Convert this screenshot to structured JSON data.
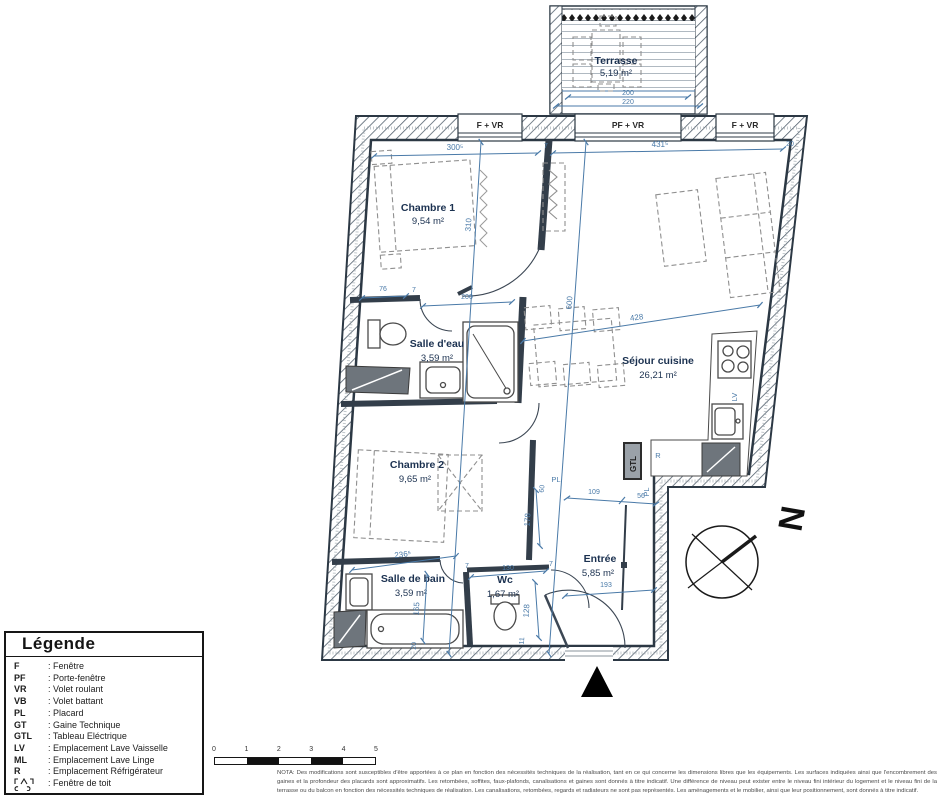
{
  "colors": {
    "wall": "#35424f",
    "dimension_blue": "#4a7aa8",
    "room_label_navy": "#1b3150",
    "furniture_gray": "#8f8f8f"
  },
  "terrace": {
    "name": "Terrasse",
    "area": "5,19 m²",
    "dim_inner": "200",
    "dim_outer": "220"
  },
  "windows": {
    "left": "F + VR",
    "center": "PF + VR",
    "right": "F + VR"
  },
  "rooms": {
    "chambre1": {
      "name": "Chambre 1",
      "area": "9,54 m²"
    },
    "salle_deau": {
      "name": "Salle d'eau",
      "area": "3,59 m²"
    },
    "sejour": {
      "name": "Séjour cuisine",
      "area": "26,21 m²"
    },
    "chambre2": {
      "name": "Chambre 2",
      "area": "9,65 m²"
    },
    "salle_de_bain": {
      "name": "Salle de bain",
      "area": "3,59 m²"
    },
    "wc": {
      "name": "Wc",
      "area": "1,67 m²"
    },
    "entree": {
      "name": "Entrée",
      "area": "5,85 m²"
    }
  },
  "annotations": {
    "pl_chambre2": "PL",
    "pl_entree": "PL",
    "gtl": "GTL",
    "refrigerateur": "R",
    "lave_vaisselle": "LV",
    "north": "N"
  },
  "dimensions": {
    "top_left": "300⁵",
    "top_wall": "7",
    "top_right": "431⁵",
    "top_end": "20",
    "chambre1_height": "310",
    "sejour_height": "600",
    "sde_left": "76",
    "sde_wall": "7",
    "sde_width": "200",
    "sejour_width": "428",
    "chambre2_width": "236⁵",
    "chambre2_height": "178",
    "chambre2_pl": "60",
    "sdb_height": "165",
    "sdb_bottom": "20",
    "wc_width": "130",
    "wc_height": "128",
    "wc_bottom": "11",
    "wc_wall_a": "7",
    "wc_wall_b": "7",
    "entree_top1": "109",
    "entree_top2": "56",
    "entree_width": "193"
  },
  "legend": {
    "title": "Légende",
    "items": [
      {
        "abbr": "F",
        "label": ": Fenêtre"
      },
      {
        "abbr": "PF",
        "label": ": Porte-fenêtre"
      },
      {
        "abbr": "VR",
        "label": ": Volet roulant"
      },
      {
        "abbr": "VB",
        "label": ": Volet battant"
      },
      {
        "abbr": "PL",
        "label": ": Placard"
      },
      {
        "abbr": "GT",
        "label": ": Gaine Technique"
      },
      {
        "abbr": "GTL",
        "label": ": Tableau Eléctrique"
      },
      {
        "abbr": "LV",
        "label": ": Emplacement Lave Vaisselle"
      },
      {
        "abbr": "ML",
        "label": ": Emplacement Lave Linge"
      },
      {
        "abbr": "R",
        "label": ": Emplacement Réfrigérateur"
      },
      {
        "abbr": "",
        "label": ": Fenêtre de toit"
      }
    ]
  },
  "scale_bar": {
    "ticks": [
      "0",
      "1",
      "2",
      "3",
      "4",
      "5"
    ]
  },
  "nota": "NOTA: Des modifications sont susceptibles d'être apportées à ce plan en fonction des nécessités techniques de la réalisation, tant en ce qui concerne les dimensions libres que les équipements. Les surfaces indiquées ainsi que l'encombrement des gaines et la profondeur des placards sont approximatifs. Les retombées, soffites, faux-plafonds, canalisations et gaines sont donnés à titre indicatif. Une différence de niveau peut exister entre le niveau fini intérieur du logement et le niveau fini de la terrasse ou du balcon en fonction des nécessités techniques de réalisation. Les canalisations, retombées, regards et radiateurs ne sont pas représentés. Les aménagements et le mobilier, ainsi que leur positionnement, sont donnés à titre indicatif."
}
